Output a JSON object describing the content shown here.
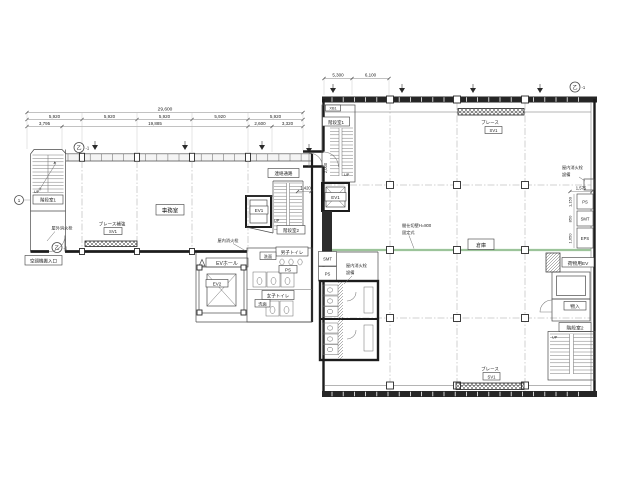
{
  "dims": {
    "total": "29,600",
    "bays": [
      "5,920",
      "5,920",
      "5,920",
      "5,920",
      "5,920"
    ],
    "sub": [
      "3,795",
      "19,885",
      "2,600",
      "3,320"
    ],
    "right_top": [
      "5,300",
      "6,100"
    ],
    "stair_w": "1,420",
    "stair_h": "2,000",
    "shaft_w": "1,575",
    "shaft_h": [
      "1,150",
      "850",
      "1,650"
    ]
  },
  "rooms": {
    "stair1": "階段室1",
    "stair2": "階段室2",
    "office": "事務室",
    "corridor": "連絡通路",
    "ev1": "EV1",
    "ev2": "EV2",
    "ev_hall": "EVホール",
    "mens_toilet": "男子トイレ",
    "womens_toilet": "女子トイレ",
    "wash": "洗面",
    "ps": "PS",
    "smt": "SMT",
    "eps": "EPS",
    "freight_ev": "荷物用EV",
    "storage": "物入",
    "warehouse": "倉庫"
  },
  "notes": {
    "brace_reinf": "ブレース補強",
    "brace": "ブレース",
    "sv1": "SV1",
    "outdoor_hydrant": "屋外消火栓",
    "indoor_hydrant": "屋内消火栓",
    "equipment": "設備",
    "hvac_entry": "空調機搬入口",
    "partition1": "間仕切壁H=800",
    "partition2": "固定式",
    "up": "UP",
    "xb": "XB1"
  },
  "marker": {
    "bubble": "乙",
    "suffix": "-1",
    "grid1": "1"
  },
  "colors": {
    "partition_green": "#9cc49a",
    "wall": "#1c1c1c"
  }
}
